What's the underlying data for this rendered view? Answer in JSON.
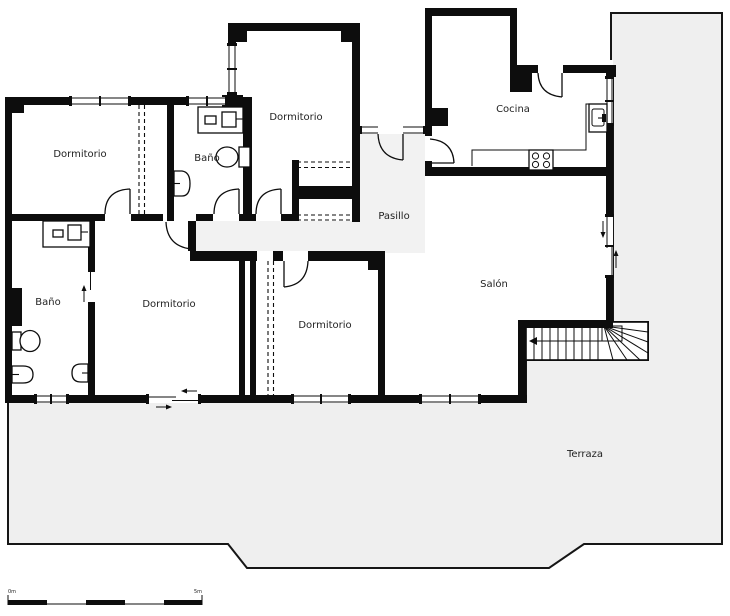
{
  "rooms": {
    "dormitorio_nw": "Dormitorio",
    "bano_n": "Baño",
    "dormitorio_n": "Dormitorio",
    "cocina": "Cocina",
    "pasillo": "Pasillo",
    "salon": "Salón",
    "bano_sw": "Baño",
    "dormitorio_sw": "Dormitorio",
    "dormitorio_s": "Dormitorio",
    "terraza": "Terraza"
  },
  "scale_bar": {
    "min_label": "0m",
    "max_label": "5m"
  },
  "colors": {
    "wall": "#0d0d0d",
    "room_fill": "#ffffff",
    "terrace_fill": "#efefef",
    "hall_fill": "#f2f2f2",
    "label_color": "#1f1f1f",
    "outline": "#161616"
  }
}
